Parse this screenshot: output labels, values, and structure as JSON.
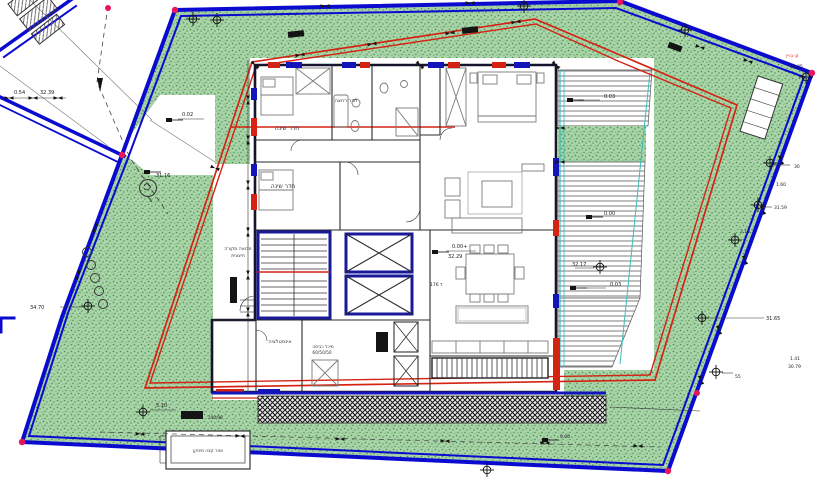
{
  "colors": {
    "boundary-blue": "#0b0bd0",
    "setback-red": "#d42313",
    "grass": "#a9d3a9",
    "grass-dot": "#478f47",
    "grass-dot2": "#6ab06a",
    "wall-dark": "#14142e",
    "core-blue": "#1a1a99",
    "window-red": "#d42313",
    "window-blue": "#1414bb",
    "deck-cyan": "#3bbcbc",
    "marker-pink": "#e8175d"
  },
  "rooms": [
    {
      "text": "חדר שינה"
    },
    {
      "text": "חדר רחצה"
    },
    {
      "text": "חדר שינה"
    },
    {
      "text": "מבואה מקורה"
    },
    {
      "text": "חיצונית"
    },
    {
      "text": "אינסטלציה"
    },
    {
      "text": "מיכל כביסה"
    },
    {
      "text": "60/50/50"
    },
    {
      "text": "אזור קצה מיתקן"
    }
  ],
  "elevations": [
    {
      "text": "0.02"
    },
    {
      "text": "31.16"
    },
    {
      "text": "34.70"
    },
    {
      "text": "0.54"
    },
    {
      "text": "32.39"
    },
    {
      "text": "0.03"
    },
    {
      "text": "0.00"
    },
    {
      "text": "0.00+"
    },
    {
      "text": "32.29"
    },
    {
      "text": "32.17"
    },
    {
      "text": "0.03"
    },
    {
      "text": "ד 176"
    },
    {
      "text": "31.05"
    },
    {
      "text": "30"
    },
    {
      "text": "1.60"
    },
    {
      "text": "31.59"
    },
    {
      "text": "2.10"
    },
    {
      "text": "31.65"
    },
    {
      "text": "55"
    },
    {
      "text": "1.41"
    },
    {
      "text": "30.79"
    },
    {
      "text": "5.10"
    },
    {
      "text": "240/98"
    },
    {
      "text": "0.00"
    },
    {
      "text": "קו בניין"
    }
  ]
}
